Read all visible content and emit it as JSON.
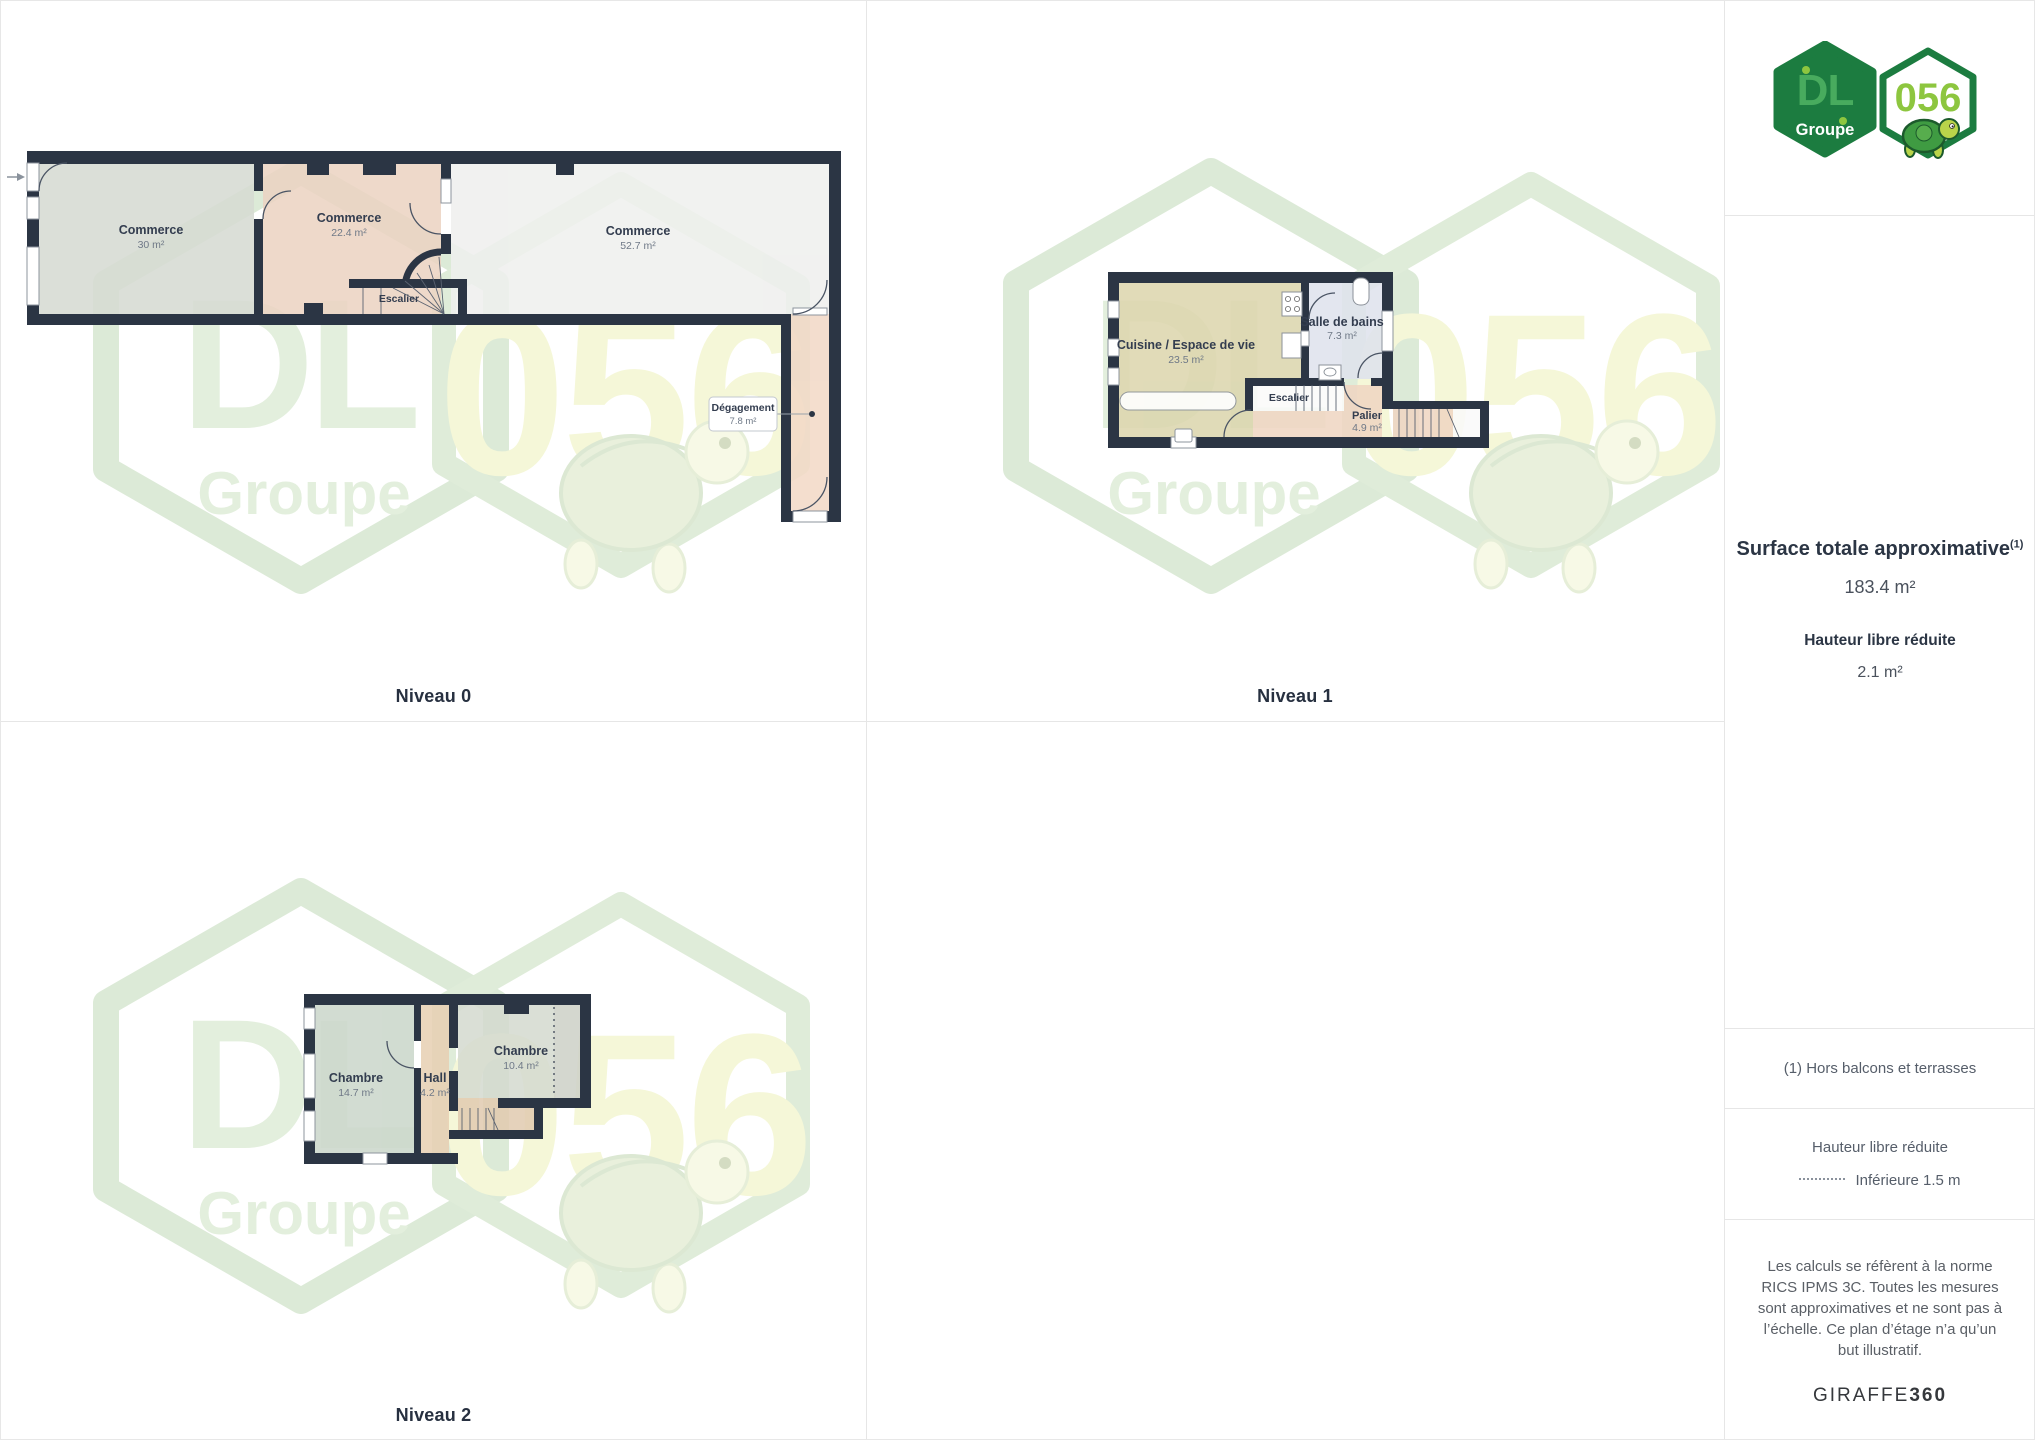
{
  "brand_logo": {
    "dl": "DL",
    "groupe": "Groupe",
    "code": "056"
  },
  "floors": [
    {
      "title": "Niveau 0",
      "rooms": [
        {
          "name": "Commerce",
          "area": "30 m²"
        },
        {
          "name": "Commerce",
          "area": "22.4 m²"
        },
        {
          "name": "Commerce",
          "area": "52.7 m²"
        },
        {
          "name": "Escalier",
          "area": ""
        },
        {
          "name": "Dégagement",
          "area": "7.8 m²"
        }
      ]
    },
    {
      "title": "Niveau 1",
      "rooms": [
        {
          "name": "Cuisine / Espace de vie",
          "area": "23.5 m²"
        },
        {
          "name": "Salle de bains",
          "area": "7.3 m²"
        },
        {
          "name": "Escalier",
          "area": ""
        },
        {
          "name": "Palier",
          "area": "4.9 m²"
        }
      ]
    },
    {
      "title": "Niveau 2",
      "rooms": [
        {
          "name": "Chambre",
          "area": "14.7 m²"
        },
        {
          "name": "Hall",
          "area": "4.2 m²"
        },
        {
          "name": "Chambre",
          "area": "10.4 m²"
        }
      ]
    }
  ],
  "sidebar": {
    "surface_label": "Surface totale approximative",
    "surface_footnote_ref": "(1)",
    "surface_value": "183.4 m²",
    "reduced_height_label": "Hauteur libre réduite",
    "reduced_height_value": "2.1 m²",
    "footnote": "(1) Hors balcons et terrasses",
    "legend_title": "Hauteur libre réduite",
    "legend_item": "Inférieure 1.5 m",
    "disclaimer": "Les calculs se réfèrent à la norme RICS IPMS 3C. Toutes les mesures sont approximatives et ne sont pas à l’échelle. Ce plan d’étage n’a qu’un but illustratif.",
    "brand": "GIRAFFE",
    "brand_suffix": "360"
  }
}
